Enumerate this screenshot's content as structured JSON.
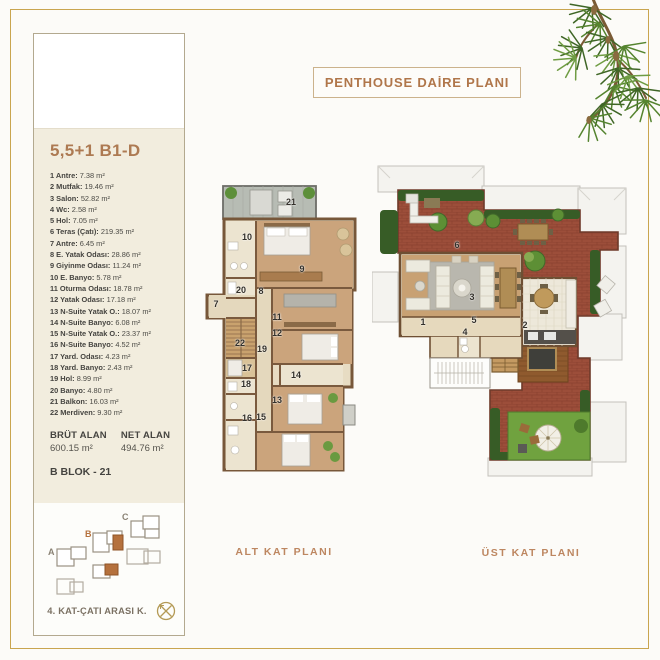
{
  "title": "PENTHOUSE DAİRE PLANI",
  "sidebar": {
    "unit_type": "5,5+1 B1-D",
    "rooms": [
      {
        "label": "1 Antre:",
        "area": "7.38 m²"
      },
      {
        "label": "2 Mutfak:",
        "area": "19.46 m²"
      },
      {
        "label": "3 Salon:",
        "area": "52.82 m²"
      },
      {
        "label": "4 Wc:",
        "area": "2.58 m²"
      },
      {
        "label": "5 Hol:",
        "area": "7.05 m²"
      },
      {
        "label": "6 Teras (Çatı):",
        "area": "219.35 m²"
      },
      {
        "label": "7 Antre:",
        "area": "6.45 m²"
      },
      {
        "label": "8 E. Yatak Odası:",
        "area": "28.86 m²"
      },
      {
        "label": "9 Giyinme Odası:",
        "area": "11.24 m²"
      },
      {
        "label": "10 E. Banyo:",
        "area": "5.78 m²"
      },
      {
        "label": "11 Oturma Odası:",
        "area": "18.78 m²"
      },
      {
        "label": "12 Yatak Odası:",
        "area": "17.18 m²"
      },
      {
        "label": "13 N-Suite Yatak O.:",
        "area": "18.07 m²"
      },
      {
        "label": "14 N-Suite Banyo:",
        "area": "6.08 m²"
      },
      {
        "label": "15 N-Suite Yatak O.:",
        "area": "23.37 m²"
      },
      {
        "label": "16 N-Suite Banyo:",
        "area": "4.52 m²"
      },
      {
        "label": "17 Yard. Odası:",
        "area": "4.23 m²"
      },
      {
        "label": "18 Yard. Banyo:",
        "area": "2.43 m²"
      },
      {
        "label": "19 Hol:",
        "area": "8.99 m²"
      },
      {
        "label": "20 Banyo:",
        "area": "4.80 m²"
      },
      {
        "label": "21 Balkon:",
        "area": "16.03 m²"
      },
      {
        "label": "22 Merdiven:",
        "area": "9.30 m²"
      }
    ],
    "brut_label": "BRÜT ALAN",
    "brut_value": "600.15 m²",
    "net_label": "NET ALAN",
    "net_value": "494.76 m²",
    "block": "B BLOK - 21"
  },
  "site_plan": {
    "label": "4. KAT-ÇATI ARASI K.",
    "block_a": "A",
    "block_b": "B",
    "block_c": "C"
  },
  "plans": {
    "alt": {
      "label": "ALT KAT PLANI",
      "numbers": [
        "21",
        "10",
        "9",
        "20",
        "8",
        "7",
        "11",
        "12",
        "22",
        "19",
        "17",
        "14",
        "18",
        "13",
        "16",
        "15"
      ]
    },
    "ust": {
      "label": "ÜST KAT PLANI",
      "numbers": [
        "6",
        "3",
        "1",
        "5",
        "2",
        "4"
      ]
    }
  },
  "colors": {
    "frame_gold": "#c9a54f",
    "bronze_text": "#b0764a",
    "panel_cream": "#f2edde",
    "terrace_brick": "#9c4e3a",
    "wood_floor": "#c8a173",
    "grass": "#70a23f",
    "highlight_orange": "#b5713d"
  }
}
